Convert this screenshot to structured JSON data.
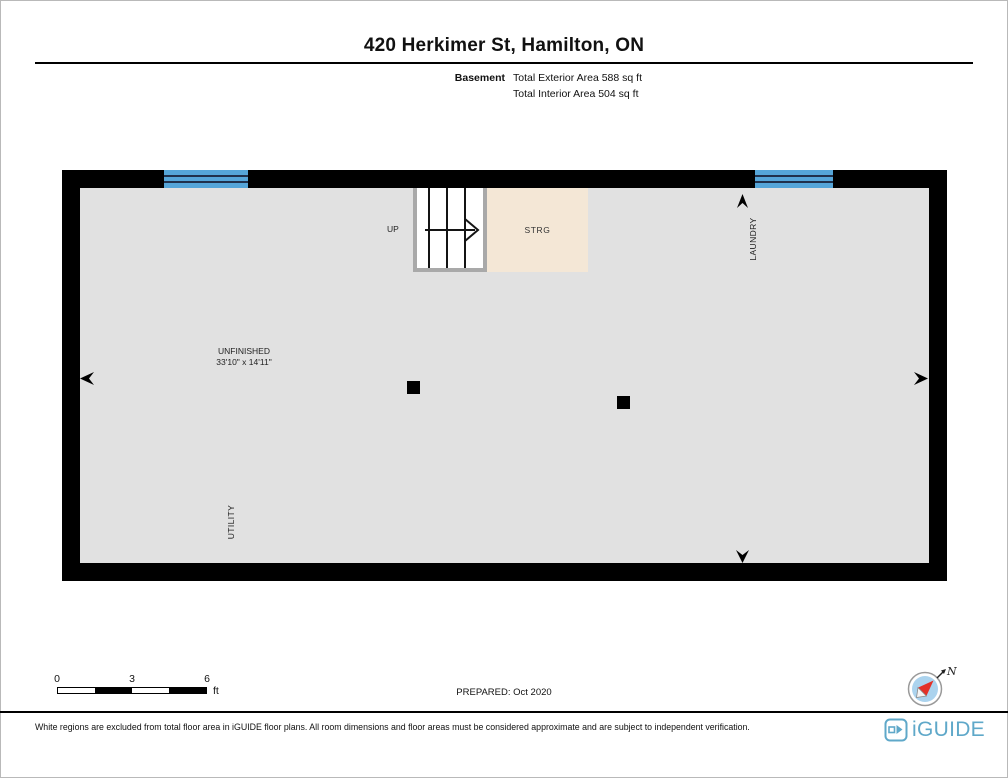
{
  "header": {
    "title": "420 Herkimer St, Hamilton, ON",
    "floor_label": "Basement",
    "exterior_area": "Total Exterior Area 588 sq ft",
    "interior_area": "Total Interior Area 504 sq ft"
  },
  "plan": {
    "labels": {
      "up": "UP",
      "storage": "STRG",
      "laundry": "LAUNDRY",
      "unfinished_name": "UNFINISHED",
      "unfinished_dims": "33'10\" x 14'11\"",
      "utility": "UTILITY"
    },
    "colors": {
      "wall": "#000000",
      "floor": "#e1e1e1",
      "window": "#55a5d8",
      "storage_fill": "#f4e7d6",
      "stair_fill": "#ffffff"
    }
  },
  "scale_bar": {
    "ticks": [
      "0",
      "3",
      "6"
    ],
    "unit": "ft"
  },
  "prepared_label": "PREPARED: Oct 2020",
  "compass": {
    "north_label": "N"
  },
  "footer": {
    "disclaimer": "White regions are excluded from total floor area in iGUIDE floor plans. All room dimensions and floor areas must be considered approximate and are subject to independent verification.",
    "brand": "iGUIDE",
    "brand_color": "#5fa8c9"
  }
}
